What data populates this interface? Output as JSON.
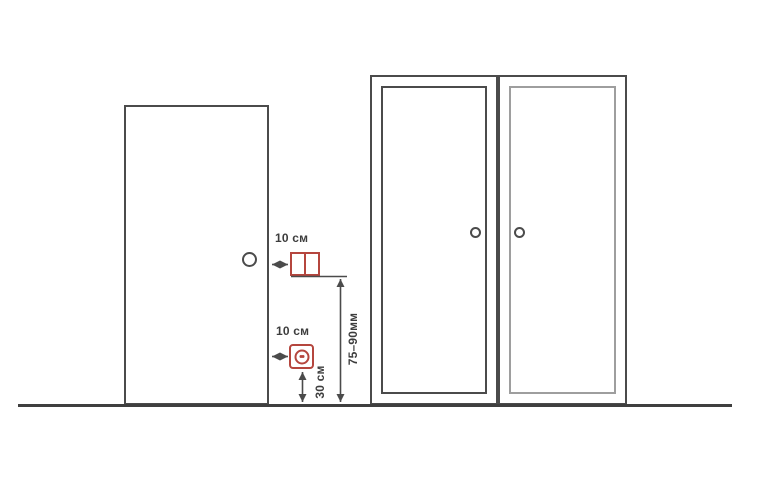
{
  "diagram": {
    "description": "door-electrical-placement-diagram",
    "annotations": {
      "switch_side_offset": "10 см",
      "outlet_side_offset": "10 см",
      "outlet_floor_height": "30 см",
      "switch_floor_height": "75–90мм"
    },
    "icons": {
      "switch": "light-switch-icon",
      "outlet": "power-outlet-icon",
      "knob": "door-knob-icon"
    },
    "colors": {
      "line": "#4b4b4b",
      "floor": "#3f3f3f",
      "accent": "#b5463e",
      "panel_light": "#9e9e9e",
      "text": "#3d3d3d"
    }
  }
}
